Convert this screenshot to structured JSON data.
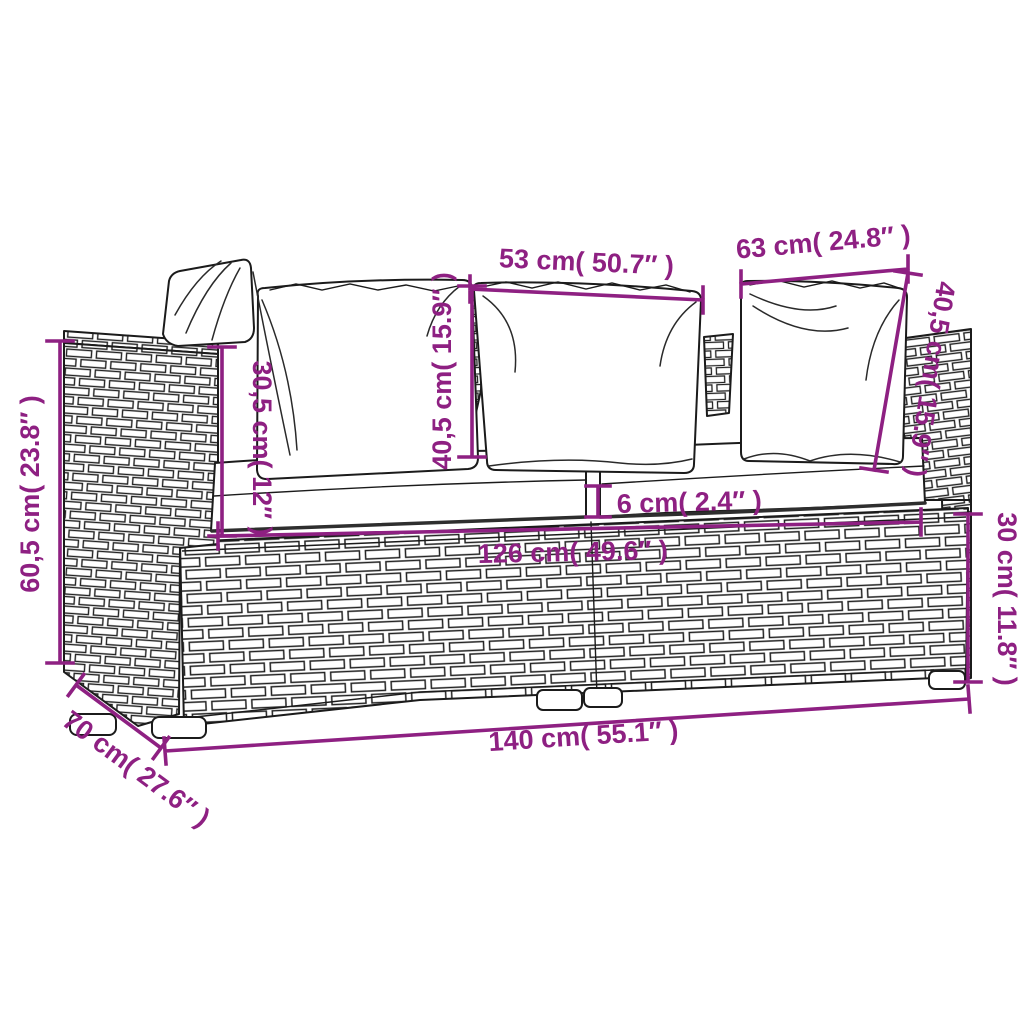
{
  "diagram": {
    "accent_color": "#8e2082",
    "line_color": "#1b1b1b",
    "background_color": "#ffffff"
  },
  "dimensions": [
    {
      "name": "back-pillow-left-width",
      "label": "53 cm( 50.7″ )"
    },
    {
      "name": "back-pillow-right-width",
      "label": "63 cm( 24.8″ )"
    },
    {
      "name": "back-pillow-center-height",
      "label": "40,5 cm( 15.9″ )"
    },
    {
      "name": "backrest-above-seat-height",
      "label": "30,5 cm( 12″ )"
    },
    {
      "name": "back-pillow-right-height",
      "label": "40,5 cm( 15.9″ )"
    },
    {
      "name": "overall-height",
      "label": "60,5 cm( 23.8″ )"
    },
    {
      "name": "seat-cushion-thickness",
      "label": "6 cm( 2.4″ )"
    },
    {
      "name": "inner-seat-width",
      "label": "126 cm( 49.6″ )"
    },
    {
      "name": "seat-base-height",
      "label": "30 cm( 11.8″ )"
    },
    {
      "name": "overall-width",
      "label": "140 cm( 55.1″ )"
    },
    {
      "name": "overall-depth",
      "label": "70 cm( 27.6″ )"
    }
  ]
}
